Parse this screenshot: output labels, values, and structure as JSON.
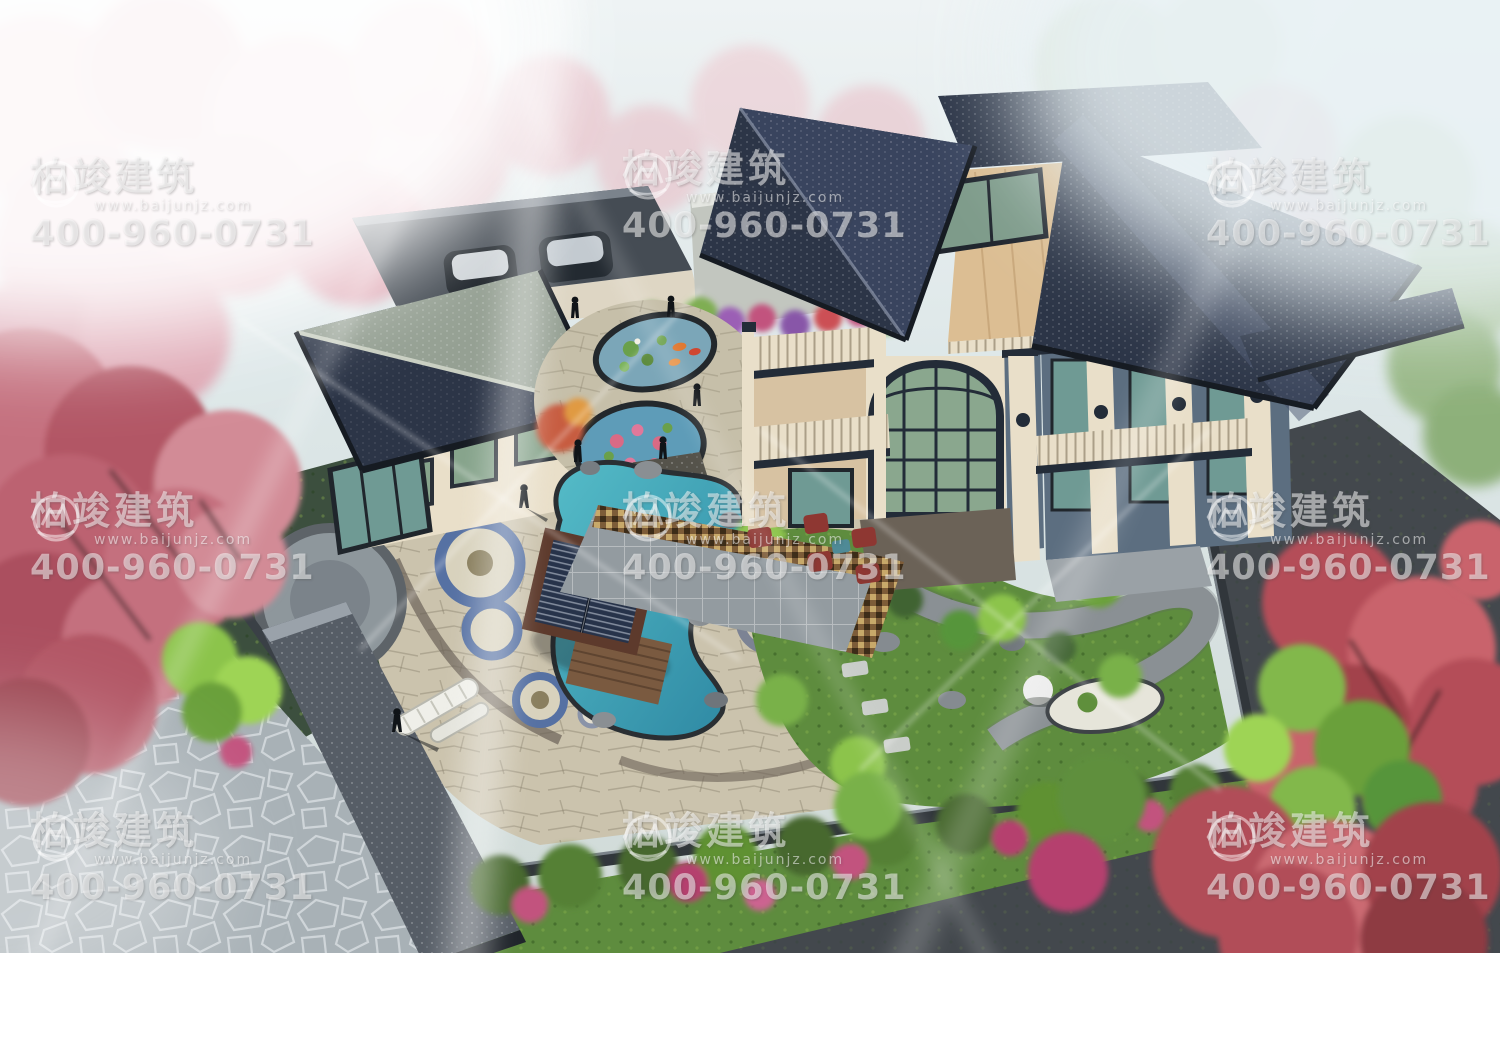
{
  "watermark": {
    "brand": "柏竣建筑",
    "website": "www.baijunjz.com",
    "phone": "400-960-0731"
  },
  "palette": {
    "roof_navy": "#2c3547",
    "roof_green_grey": "#95a093",
    "wall_cream": "#e9dfc9",
    "wall_tan": "#d7c2a2",
    "wall_bluegrey": "#5c6e80",
    "glass_green": "#87a48c",
    "water_teal": "#3fa3b6",
    "pond_blue": "#5e9cb8",
    "blossom_pink": "#d98e9d",
    "maple_red": "#b04a55",
    "bamboo_green": "#8cc44b",
    "lawn_green": "#5e8c3e",
    "paving_beige": "#cbc3ad",
    "flagstone_grey": "#a8b1b6",
    "mosaic_brown": "#7d5c38",
    "stool_red": "#8e3732",
    "inlay_blue": "#5671a3",
    "fence_dark": "#31363b"
  }
}
